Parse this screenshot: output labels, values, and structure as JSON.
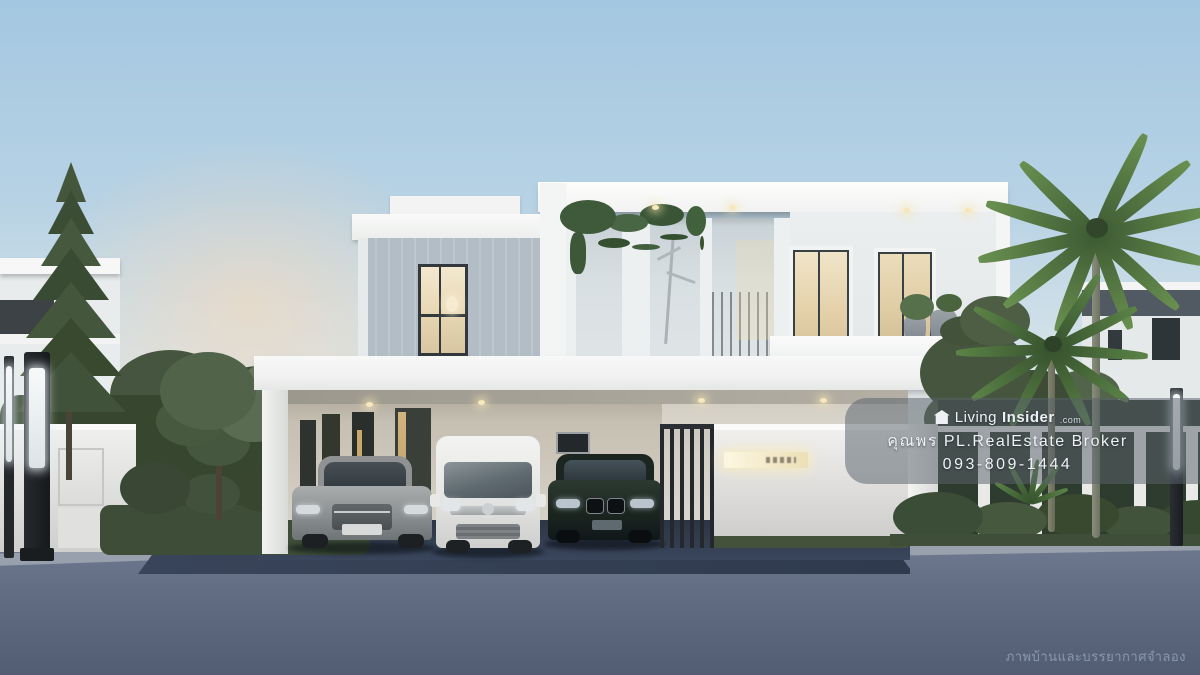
{
  "image": {
    "kind": "real-estate 3d render photograph",
    "subject": "Modern two-storey white house at dusk with carport, three parked cars, landscaped garden, front wall and street",
    "objects": [
      "two-storey modern white house",
      "silver sedan",
      "white minivan",
      "dark SUV",
      "carport",
      "front gate",
      "white front wall with lit address plate",
      "fence with hedge panels",
      "palm trees",
      "pine tree",
      "garden hedges",
      "LED lamp posts",
      "street at dusk"
    ]
  },
  "watermark": {
    "logo_icon": "home-icon",
    "brand_living": "Living",
    "brand_insider": "Insider",
    "brand_tld": ".com",
    "agent": "คุณพร PL.RealEstate Broker",
    "phone": "093-809-1444"
  },
  "caption": {
    "text": "ภาพบ้านและบรรยากาศจำลอง"
  },
  "colors": {
    "sky_top": "#a6c8e2",
    "sky_horizon": "#e8e6e0",
    "sunset_glow": "#f3d6b8",
    "road": "#5d6880",
    "driveway": "#333d4f",
    "foliage_dark": "#3c4d35",
    "foliage_light": "#6d8a58",
    "house_white": "#f4f5f4",
    "siding_blue_gray": "#b7c2cb",
    "window_warm_light": "#f0e2c2",
    "interior_wall_beige": "#d5cfc3",
    "watermark_panel": "#58616b",
    "caption_text": "#8a97ab"
  }
}
